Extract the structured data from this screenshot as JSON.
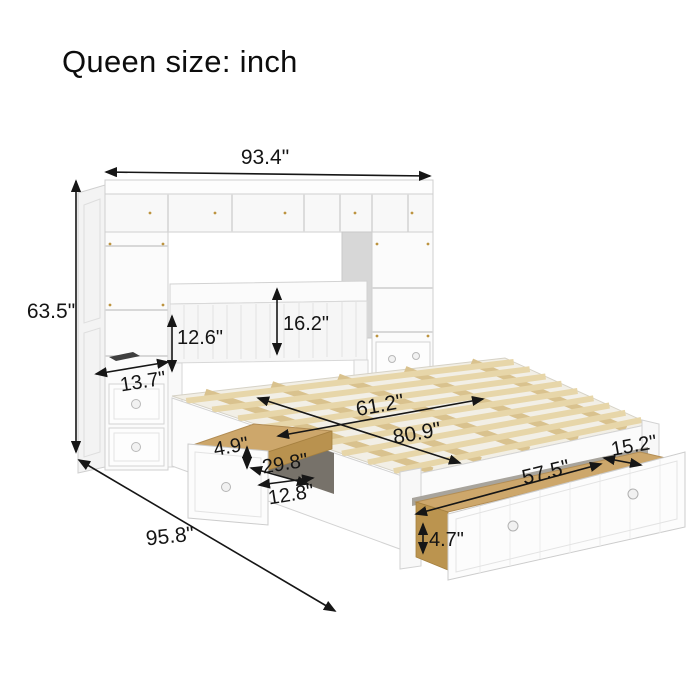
{
  "title": "Queen size: inch",
  "dimensions": {
    "overall_width": "93.4\"",
    "overall_height": "63.5\"",
    "headboard_shelf_height": "12.6\"",
    "headboard_panel_height": "16.2\"",
    "side_tower_depth": "13.7\"",
    "slat_width": "61.2\"",
    "bed_length": "80.9\"",
    "side_drawer_height": "4.9\"",
    "side_drawer_width": "29.8\"",
    "side_drawer_depth": "12.8\"",
    "foot_drawer_depth": "15.2\"",
    "foot_drawer_width": "57.5\"",
    "foot_drawer_height": "4.7\"",
    "overall_depth": "95.8\""
  },
  "colors": {
    "label_ink": "#141414",
    "furniture_white": "#fbfbfb",
    "wood_beam": "#d9c28e",
    "wood_slat": "#e7d6a9",
    "wood_drawer": "#cda76b",
    "recess_gray": "#d7d7d7"
  }
}
